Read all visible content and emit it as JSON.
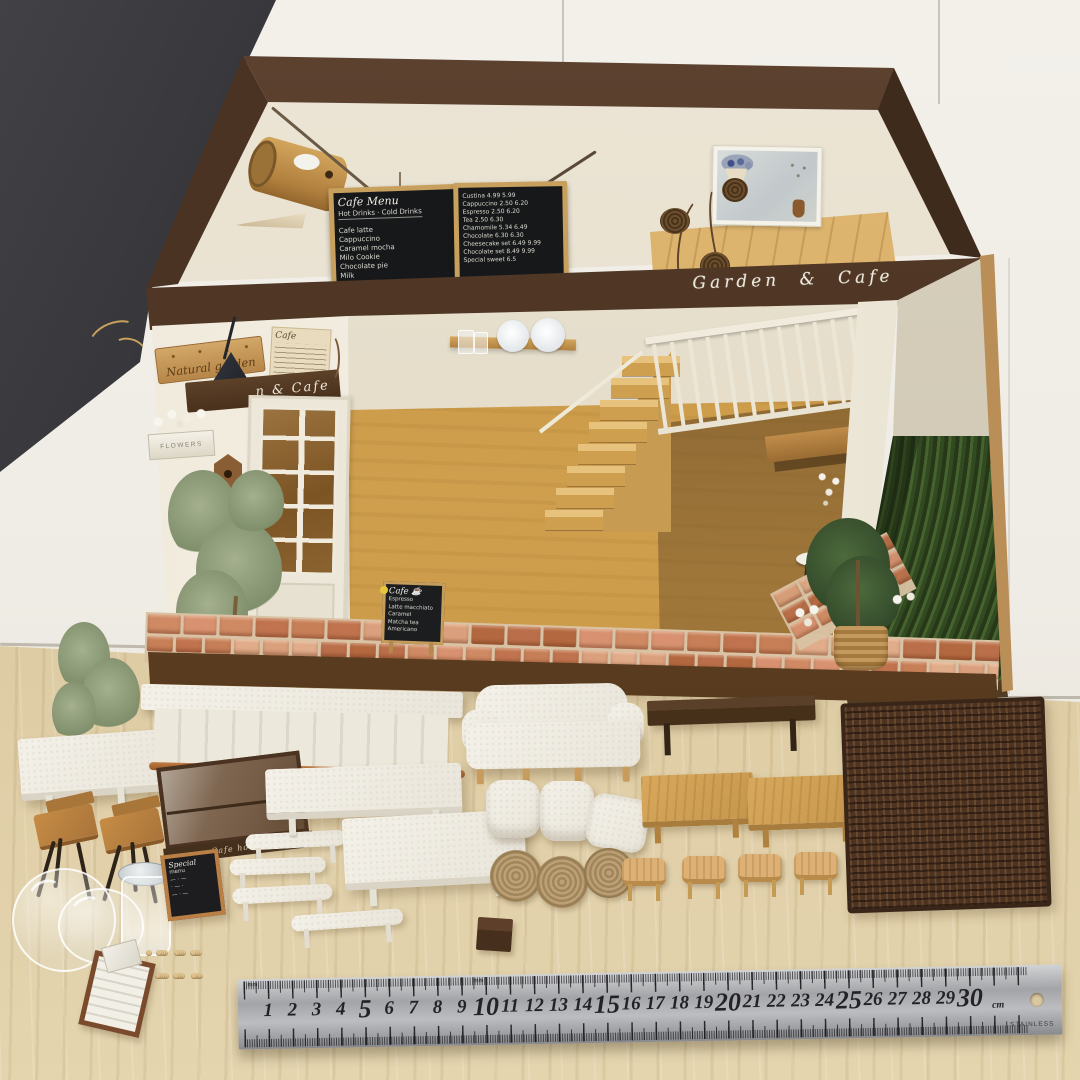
{
  "scene": {
    "title": "Handmade miniature dollhouse diorama — Garden & Cafe — with tiny furniture laid out in front and a 30 cm stainless ruler for scale"
  },
  "signs": {
    "roof_beam": "Garden  &  Cafe",
    "wood_sign": "Natural garden",
    "facade_sign": "n & Cafe",
    "poster_title": "Cafe",
    "flower_box": "FLOWERS",
    "display_case": "Cafe house",
    "special_sign_title": "Special"
  },
  "menu_board_left": {
    "title": "Cafe Menu",
    "columns": "Hot Drinks · Cold Drinks",
    "lines": [
      "Cafe latte",
      "Cappuccino",
      "Caramel mocha",
      "Milo Cookie",
      "Chocolate pie",
      "Milk"
    ]
  },
  "menu_board_right": {
    "lines": [
      "Custina 4.99 5.99",
      "Cappuccino 2.50 6.20",
      "Espresso 2.50 6.20",
      "Tea 2.50 6.30",
      "Chamomile 5.34 6.49",
      "Chocolate 6.30 6.30",
      "Cheesecake set 6.49 9.99",
      "Chocolate set 8.49 9.99",
      "Special sweet 6.5"
    ]
  },
  "aframe_board": {
    "title": "Cafe ☕",
    "lines": [
      "Espresso",
      "Latte macchiato",
      "Caramel",
      "Matcha tea",
      "Americano"
    ]
  },
  "special_sign": {
    "lines": [
      "menu",
      "— · —",
      "· — ·",
      "— · —"
    ]
  },
  "ruler": {
    "max": 30,
    "unit": "cm",
    "mm_label": "mm",
    "brand": "STAINLESS"
  },
  "colors": {
    "brick_palette": [
      "#cf8a64",
      "#c0734e",
      "#daa07d",
      "#b4683f",
      "#d89271",
      "#c77f58",
      "#e0ac8a",
      "#ba6f4a"
    ],
    "roof_brown": "#4d3526",
    "moss_green": "#32451f",
    "accent_wood": "#c89a55"
  }
}
